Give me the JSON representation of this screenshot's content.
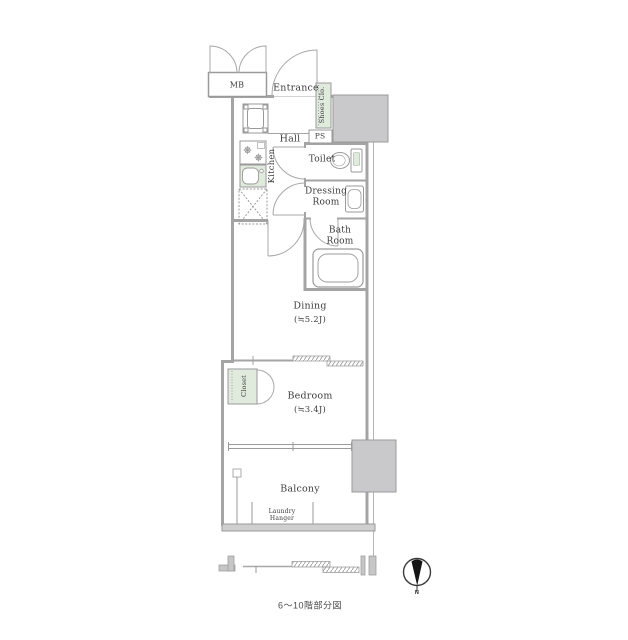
{
  "labels": {
    "mb": "MB",
    "entrance": "Entrance",
    "shoes_closet": "Shoes Clo.",
    "hall": "Hall",
    "ps": "PS",
    "kitchen": "Kitchen",
    "toilet": "Toilet",
    "dressing_room": "Dressing Room",
    "bath_room": "Bath Room",
    "dining": "Dining",
    "dining_size": "(≒5.2J)",
    "closet": "Closet",
    "bedroom": "Bedroom",
    "bedroom_size": "(≒3.4J)",
    "balcony": "Balcony",
    "laundry_hanger": "Laundry Hanger",
    "caption": "6〜10階部分図",
    "compass_north": "N"
  },
  "colors": {
    "wall_gray": "#a4a4a4",
    "line_gray": "#9a9a9a",
    "shaft_gray": "#c9c9cb",
    "fixture_green": "#e0eadd",
    "text": "#3d3d3d"
  }
}
